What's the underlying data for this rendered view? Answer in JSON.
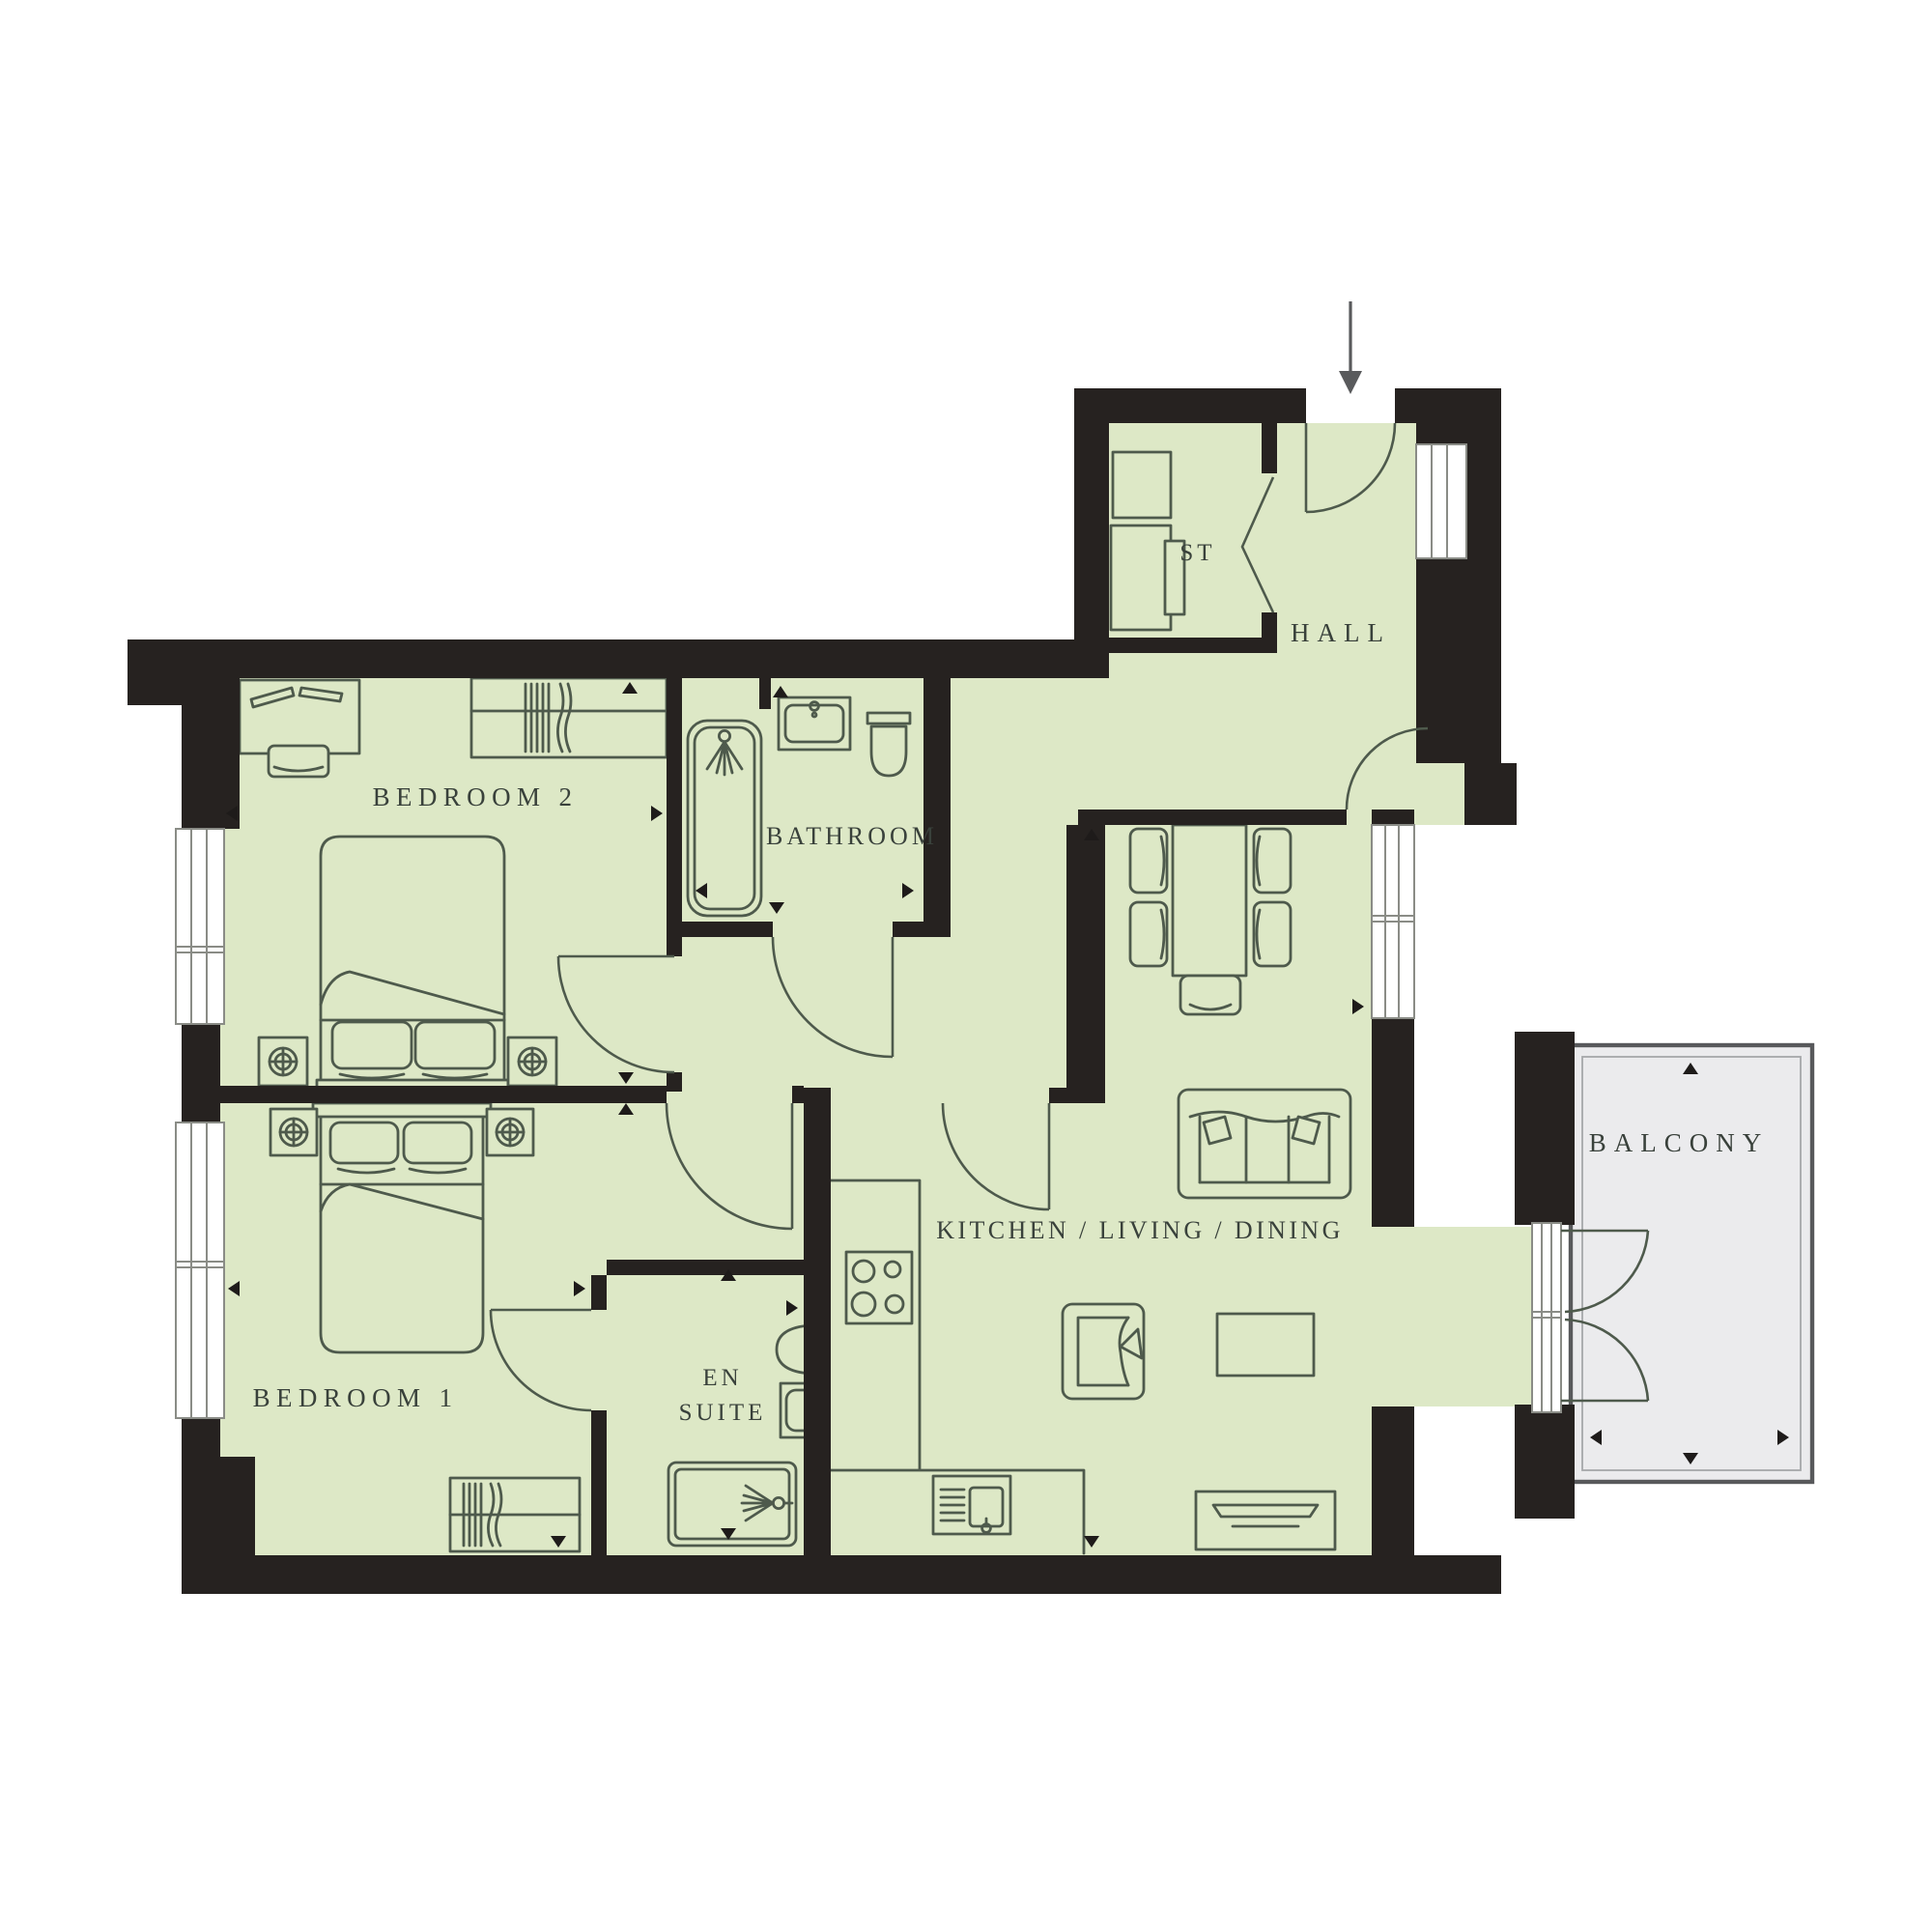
{
  "plan": {
    "rooms": {
      "bedroom2": {
        "label": "BEDROOM 2"
      },
      "bedroom1": {
        "label": "BEDROOM 1"
      },
      "bathroom": {
        "label": "BATHROOM"
      },
      "ensuite": {
        "line1": "EN",
        "line2": "SUITE"
      },
      "storage": {
        "label": "ST"
      },
      "hall": {
        "label": "HALL"
      },
      "kitchen_living_dining": {
        "label": "KITCHEN / LIVING / DINING"
      },
      "balcony": {
        "label": "BALCONY"
      }
    },
    "colors": {
      "floor": "#dde8c6",
      "wall": "#262220",
      "balcony_floor": "#ebebed",
      "balcony_border": "#58595b",
      "furniture_line": "#4e5a4c",
      "window_frame": "#8a8c86",
      "label_text": "#39413b",
      "dimension_arrow": "#1e1b1a"
    },
    "icons": {
      "entry_arrow": "entry-arrow-icon",
      "furniture": [
        "double-bed",
        "bedside-table",
        "wardrobe",
        "desk",
        "desk-chair",
        "bathtub",
        "shower-head",
        "wash-basin",
        "toilet",
        "washer",
        "dining-table",
        "dining-chair",
        "sofa",
        "armchair",
        "coffee-table",
        "tv-unit",
        "hob",
        "kitchen-sink",
        "shower-tray"
      ]
    }
  }
}
